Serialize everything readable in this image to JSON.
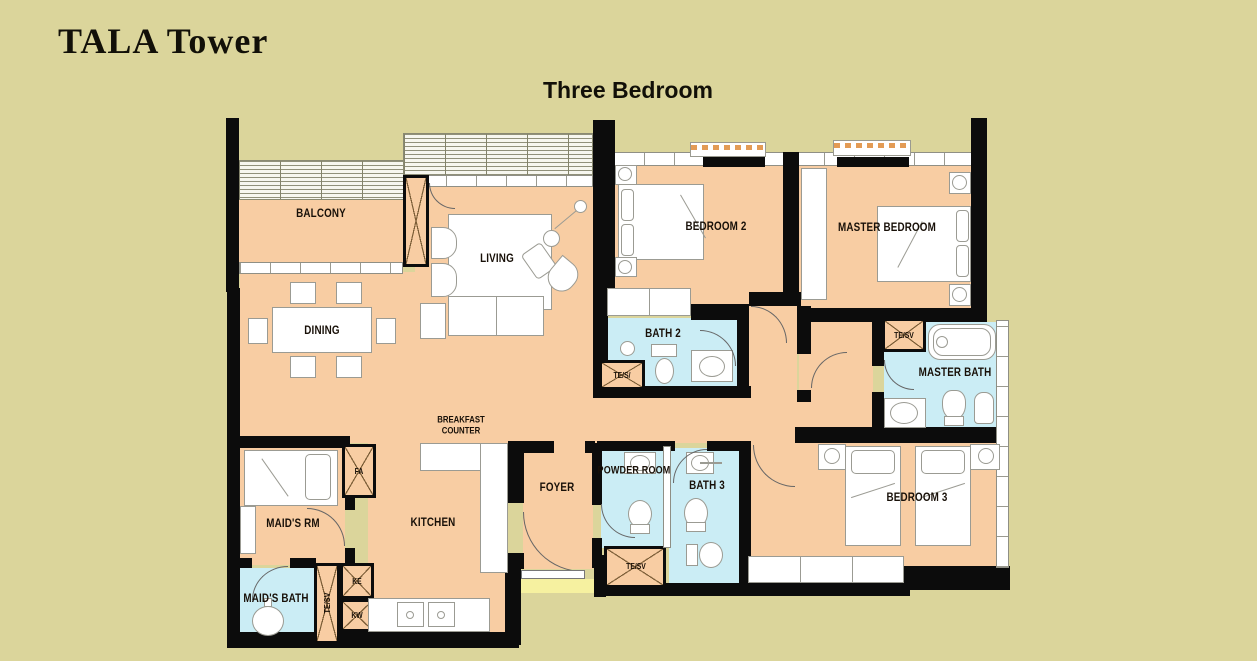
{
  "header": {
    "title": "TALA Tower",
    "subtitle_line1": "Three Bedroom",
    "subtitle_line2": "Type E  (191Sqm)"
  },
  "colors": {
    "background": "#DBD59B",
    "floor": "#F8CDA3",
    "bath_floor": "#CBEDF5",
    "wall": "#0C0C0C",
    "threshold": "#F6F1A0"
  },
  "rooms": {
    "balcony": "BALCONY",
    "living": "LIVING",
    "dining": "DINING",
    "bedroom2": "BEDROOM 2",
    "master_bedroom": "MASTER BEDROOM",
    "bath2": "BATH 2",
    "master_bath": "MASTER BATH",
    "breakfast_line1": "BREAKFAST",
    "breakfast_line2": "COUNTER",
    "kitchen": "KITCHEN",
    "foyer": "FOYER",
    "powder_room": "POWDER ROOM",
    "bath3": "BATH 3",
    "bedroom3": "BEDROOM 3",
    "maids_room": "MAID'S RM",
    "maids_bath": "MAID'S BATH"
  },
  "shafts": {
    "te_sv_bath2": "TE/S/",
    "te_sv_master": "TE/SV",
    "te_sv_foyer": "TE/SV",
    "te_sv_maids": "TE/SV",
    "fa": "FA",
    "ke": "KE",
    "kw": "KW"
  }
}
